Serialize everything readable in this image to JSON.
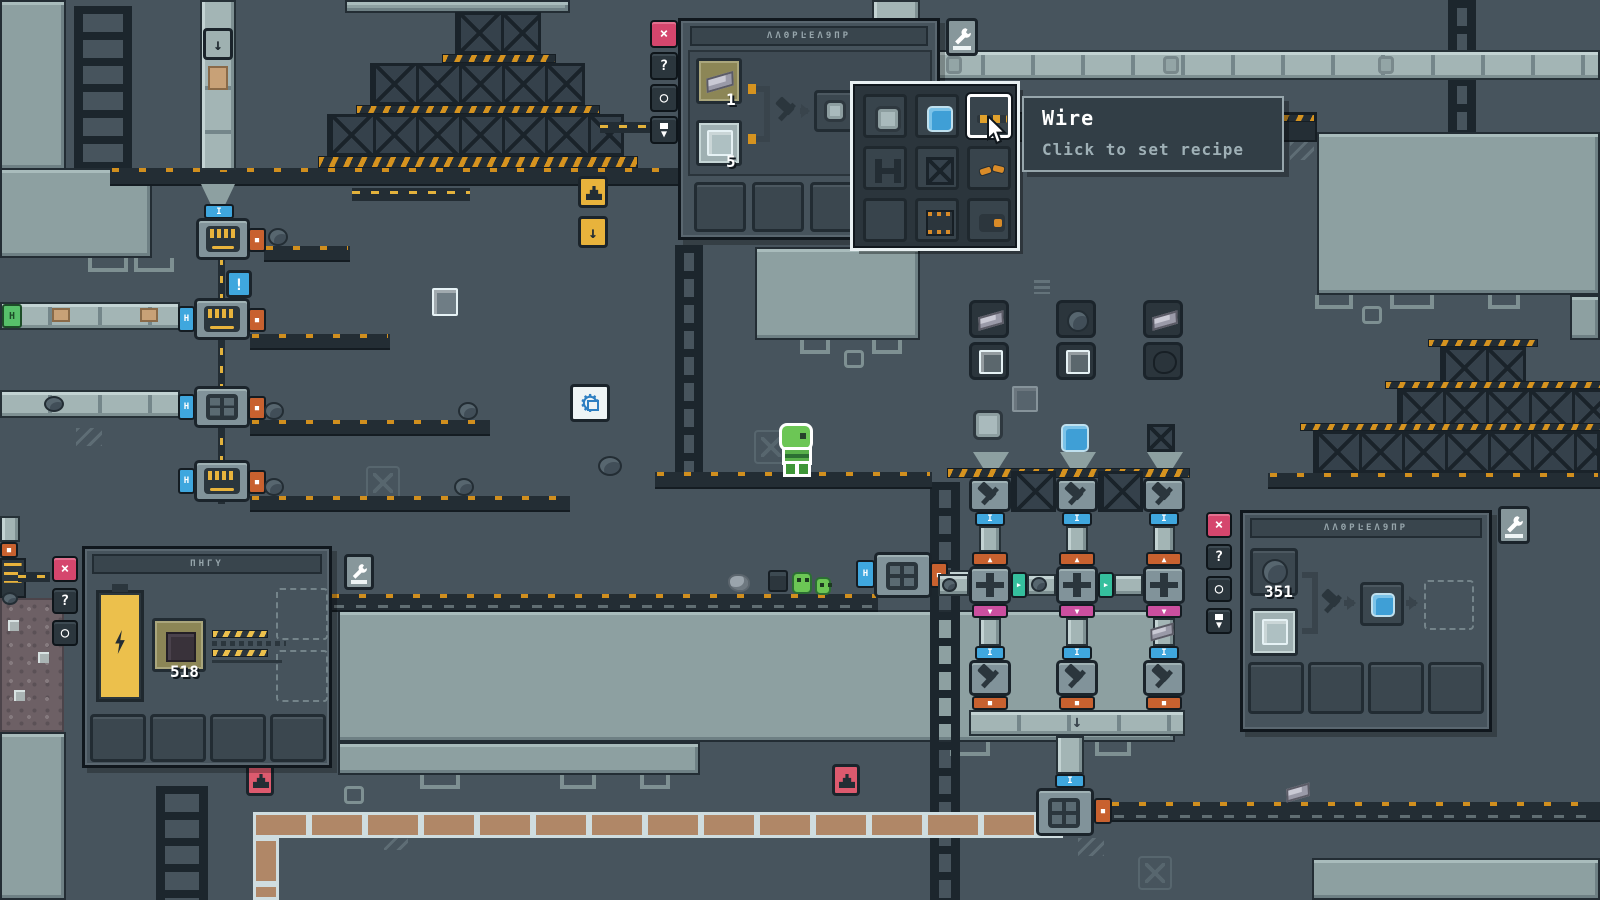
{
  "colors": {
    "background": "#47545d",
    "light_panel": "#8da0a1",
    "accent_orange": "#d6931f",
    "accent_blue": "#3fa7de",
    "accent_pink": "#d5466d",
    "accent_teal": "#35bf9d",
    "accent_magenta": "#cb4f9f",
    "machine_orange": "#c8612f",
    "creature_green": "#6cc655",
    "battery_yellow": "#ecc04c"
  },
  "window_buttons": {
    "close": "×",
    "help": "?",
    "pin": "○",
    "filter": "▼"
  },
  "tooltip": {
    "title": "Wire",
    "subtitle": "Click to set recipe"
  },
  "top_assembler_panel": {
    "title_glyphs": "ΛΛΘΡĿΕΛ9ΠΡ",
    "inputs": [
      {
        "item": "metal-ingot",
        "count": "1"
      },
      {
        "item": "glass-plate",
        "count": "5"
      }
    ],
    "output": {
      "item": "metal-plate"
    },
    "queue_slots": 4
  },
  "recipe_popup": {
    "items": [
      {
        "name": "metal-plate",
        "selected": false
      },
      {
        "name": "blue-plate",
        "selected": false
      },
      {
        "name": "wire",
        "selected": true
      },
      {
        "name": "rail",
        "selected": false
      },
      {
        "name": "crate",
        "selected": false
      },
      {
        "name": "coil",
        "selected": false
      },
      {
        "name": "empty",
        "selected": false
      },
      {
        "name": "circuit",
        "selected": false
      },
      {
        "name": "plug",
        "selected": false
      }
    ]
  },
  "generator_panel": {
    "title_glyphs": "ΠΗΓΥ",
    "fuel": {
      "item": "circuit-scrap",
      "count": "518"
    },
    "battery_level": "full"
  },
  "right_assembler_panel": {
    "title_glyphs": "ΛΛΘΡĿΕΛ9ΠΡ",
    "inputs": [
      {
        "item": "stone-ore",
        "count": "351"
      },
      {
        "item": "glass-plate"
      }
    ],
    "output": {
      "item": "blue-plate"
    }
  },
  "world": {
    "alert": "!",
    "sign_down_arrow": "↓",
    "connectors": {
      "io_vertical": "I",
      "io_horizontal": "H",
      "in_up": "▲",
      "out_square": "■",
      "out_right": "▶",
      "out_down": "▼"
    },
    "floating_recipes": [
      {
        "inputs": [
          "metal-ingot",
          "glass-plate"
        ],
        "output": "metal-plate"
      },
      {
        "inputs": [
          "stone-ore",
          "glass-plate"
        ],
        "output": "blue-plate"
      },
      {
        "inputs": [
          "metal-ingot",
          "coal"
        ],
        "output": "crate"
      }
    ]
  }
}
